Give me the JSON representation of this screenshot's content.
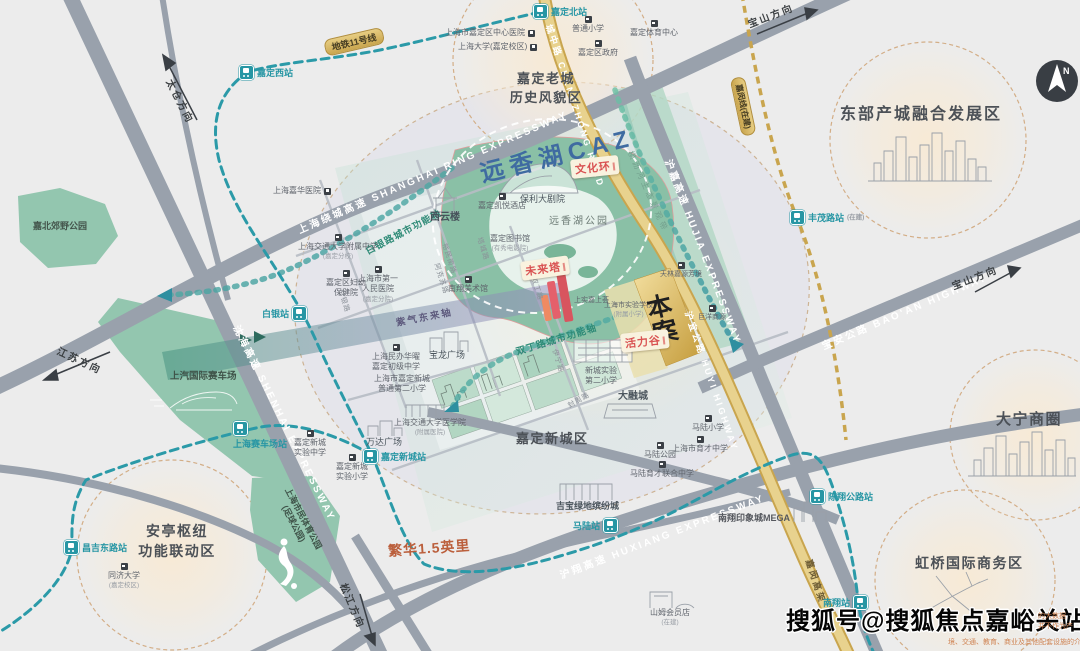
{
  "caz": {
    "title": "远香湖CAZ",
    "site": "本\n案",
    "badge_culture": "文化环",
    "badge_future": "未来塔",
    "badge_vitality": "活力谷"
  },
  "districts": [
    {
      "name": "嘉定老城\n历史风貌区"
    },
    {
      "name": "东部产城融合发展区"
    },
    {
      "name": "大宁商圈"
    },
    {
      "name": "虹桥国际商务区"
    },
    {
      "name": "安亭枢纽\n功能联动区"
    },
    {
      "name": "嘉定新城区"
    }
  ],
  "axes": {
    "baiyin": "白银路城市功能轴",
    "shuangding": "双丁路城市功能轴",
    "ziqi": "紫气东来轴",
    "hengli": "横沥河生态景观带"
  },
  "roads": {
    "ring": "上海绕城高速  SHANGHAI RING EXPRESSWAY",
    "shenhai": "沈海高速  SHENHAI EXPRESSWAY",
    "hujia": "沪嘉高速  HUJIA EXPRESSWAY",
    "baoan": "宝安公路  BAO'AN HIGHWAY",
    "huxiang": "沪翔高速  HUXIANG EXPRESSWAY",
    "chengzhong": "城中路 CHENGZHONG ROAD",
    "huyi": "沪宜公路 HUYI HIGHWAY",
    "jiamin_viaduct": "嘉闵高架",
    "minor": [
      "白银路",
      "阿克苏路",
      "塔城路",
      "裕民南路",
      "伊宁路",
      "双丁路",
      "封周路"
    ]
  },
  "directions": {
    "taicang": "太仓方向",
    "jiangsu": "江苏方向",
    "baoshan": "宝山方向",
    "songjiang": "松江方向"
  },
  "metro": {
    "line11_badge": "地铁11号线",
    "jiamin_badge": "嘉闵线(在建)",
    "stations": [
      {
        "name": "嘉定西站"
      },
      {
        "name": "嘉定北站"
      },
      {
        "name": "白银站"
      },
      {
        "name": "上海赛车场站"
      },
      {
        "name": "嘉定新城站"
      },
      {
        "name": "马陆站"
      },
      {
        "name": "陈翔公路站"
      },
      {
        "name": "南翔站"
      },
      {
        "name": "昌吉东路站"
      },
      {
        "name": "丰茂路站",
        "sub": "(在建)"
      }
    ]
  },
  "pois": [
    {
      "label": "上海市嘉定区中心医院"
    },
    {
      "label": "上海大学(嘉定校区)"
    },
    {
      "label": "普通小学"
    },
    {
      "label": "嘉定区政府"
    },
    {
      "label": "嘉定体育中心"
    },
    {
      "label": "上海嘉华医院"
    },
    {
      "label": "嘉定凯悦酒店"
    },
    {
      "label": "保利大剧院"
    },
    {
      "label": "嘉定图书馆",
      "sub": "(有秀电影院)"
    },
    {
      "label": "西云楼"
    },
    {
      "label": "远香湖公园"
    },
    {
      "label": "南翔美术馆"
    },
    {
      "label": "上海交通大学附属中学",
      "sub": "(嘉定分校)"
    },
    {
      "label": "嘉定区妇幼\n保健院"
    },
    {
      "label": "上海市第一\n人民医院",
      "sub": "(嘉定分院)"
    },
    {
      "label": "上海民办华曜\n嘉定初级中学"
    },
    {
      "label": "上海市嘉定新城\n普通第二小学"
    },
    {
      "label": "宝龙广场"
    },
    {
      "label": "万达广场"
    },
    {
      "label": "嘉定新城\n实验中学"
    },
    {
      "label": "嘉定新城\n实验小学"
    },
    {
      "label": "上海交通大学医学院",
      "sub": "(附属医院)"
    },
    {
      "label": "新城实验\n第二小学"
    },
    {
      "label": "大融城"
    },
    {
      "label": "马陆小学"
    },
    {
      "label": "上海市育才中学"
    },
    {
      "label": "马陆公园"
    },
    {
      "label": "马陆育才联合中学"
    },
    {
      "label": "吉宝绿地缤纷城"
    },
    {
      "label": "南翔印象城MEGA"
    },
    {
      "label": "山姆会员店",
      "sub": "(在建)"
    },
    {
      "label": "同济大学",
      "sub": "(嘉定校区)"
    },
    {
      "label": "上海市民体育公园\n(足球公园)"
    },
    {
      "label": "嘉北郊野公园"
    },
    {
      "label": "上汽国际赛车场"
    },
    {
      "label": "天林嘉源芳境"
    },
    {
      "label": "上实嘉上荟"
    },
    {
      "label": "巨洋商源"
    },
    {
      "label": "上海市实验学校",
      "sub": "(附属小学)"
    }
  ],
  "compass": {
    "n": "N"
  },
  "misc": {
    "scale": "繁华1.5英里",
    "watermark": "搜狐号@搜狐焦点嘉峪关站",
    "disclaimer": [
      "的大数据\n并不作为产",
      "境、交通、教育、商业及其他配套设施的介绍，旨在提供相关"
    ]
  },
  "colors": {
    "metro_teal": "#2b9aa8",
    "road_gold": "#cfa94f",
    "badge_red": "#d95252",
    "park_green": "#8cc2a9",
    "circle_tan": "#d3ae87"
  }
}
